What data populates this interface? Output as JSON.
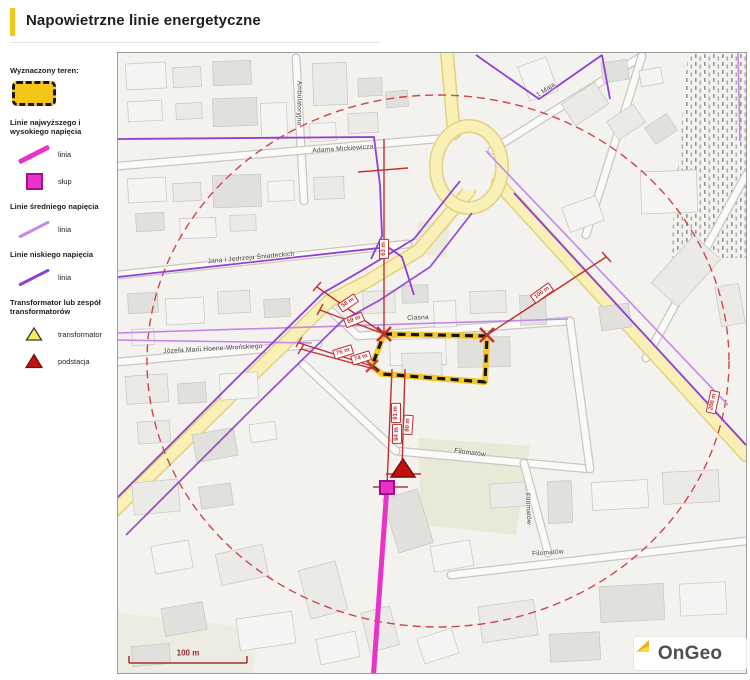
{
  "header": {
    "title": "Napowietrzne linie energetyczne"
  },
  "legend": {
    "area_title": "Wyznaczony teren:",
    "hv_title": "Linie najwyższego i wysokiego napięcia",
    "hv_line": "linia",
    "hv_pole": "słup",
    "mv_title": "Linie średniego napięcia",
    "mv_line": "linia",
    "lv_title": "Linie niskiego napięcia",
    "lv_line": "linia",
    "tr_title": "Transformator lub zespół transformatorów",
    "tr_transformer": "transformator",
    "tr_substation": "podstacja"
  },
  "map": {
    "streets": [
      {
        "name": "Ambulatoryjna"
      },
      {
        "name": "Adama Mickiewicza"
      },
      {
        "name": "Jana i Jędrzeja Śniadeckich"
      },
      {
        "name": "Józefa Marii Hoene-Wrońskiego"
      },
      {
        "name": "Ciasna"
      },
      {
        "name": "1 Maja"
      },
      {
        "name": "Filomatów"
      },
      {
        "name": "Filomatów"
      },
      {
        "name": "Filomatów"
      }
    ],
    "measurements": [
      {
        "label": "63 m"
      },
      {
        "label": "58 m"
      },
      {
        "label": "59 m"
      },
      {
        "label": "76 m"
      },
      {
        "label": "74 m"
      },
      {
        "label": "106 m"
      },
      {
        "label": "91 m"
      },
      {
        "label": "94 m"
      },
      {
        "label": "80 m"
      },
      {
        "label": "200 m"
      }
    ],
    "scale_label": "100 m",
    "logo_text": "OnGeo"
  },
  "colors": {
    "accent": "#f5c518",
    "hv": "#e832ca",
    "hvPoleBorder": "#a80f8f",
    "mv": "#c488e8",
    "lv": "#8f3fd2",
    "measure": "#c03030",
    "circle": "#d04545",
    "transformerFill": "#f5ef5e",
    "substationFill": "#bf1111"
  }
}
